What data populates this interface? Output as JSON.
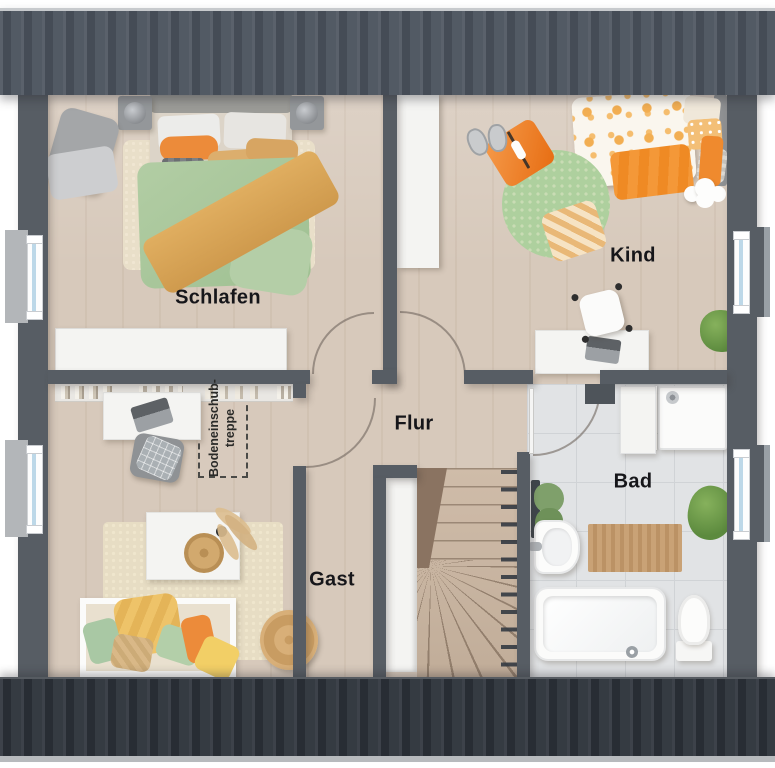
{
  "rooms": [
    {
      "id": "schlafen",
      "label": "Schlafen"
    },
    {
      "id": "kind",
      "label": "Kind"
    },
    {
      "id": "flur",
      "label": "Flur"
    },
    {
      "id": "bad",
      "label": "Bad"
    },
    {
      "id": "gast",
      "label": "Gast"
    }
  ],
  "annotations": {
    "attic_stairs_line1": "Bodeneinschub-",
    "attic_stairs_line2": "treppe"
  },
  "colors": {
    "roof_top": "#4d545d",
    "roof_bottom": "#34393f",
    "wall": "#575d64",
    "floor_wood": "#d7c9bb",
    "floor_tile": "#e1e3e5",
    "window_glass": "#bdd8e8",
    "accent_orange": "#ec8b3a",
    "accent_green": "#a9c79c",
    "accent_ochre": "#d9a458"
  }
}
